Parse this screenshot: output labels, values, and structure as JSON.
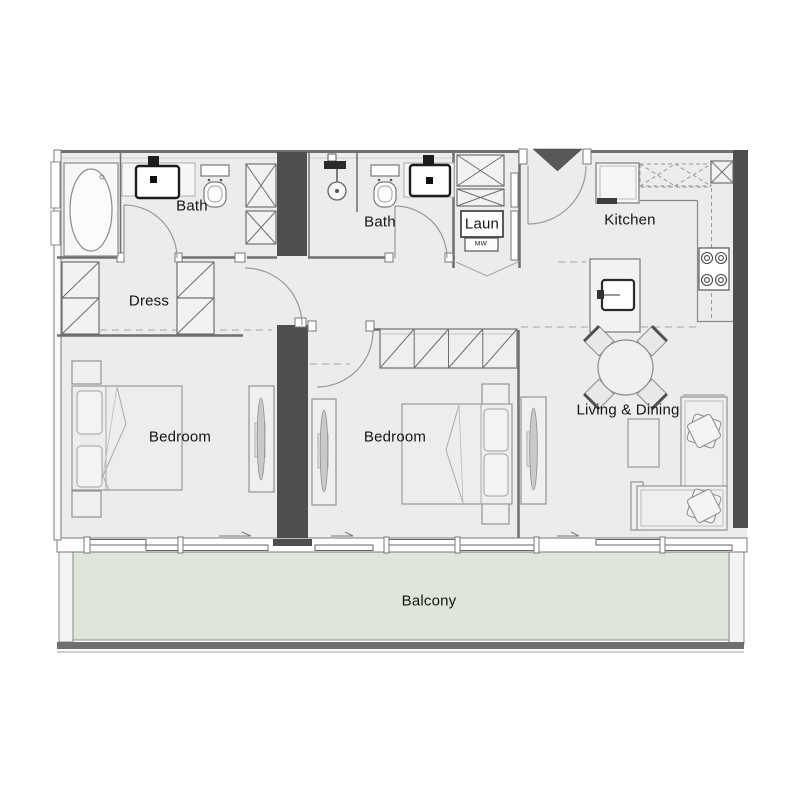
{
  "colors": {
    "background": "#ffffff",
    "floor": "#ececea",
    "balcony_floor": "#dfe5d9",
    "wall_dark": "#4e4e4e",
    "wall_line": "#6f6f6f",
    "furniture_line": "#8a8a8a",
    "fixture_line": "#1c1c1c",
    "text": "#151515"
  },
  "rooms": {
    "bath_main": {
      "label": "Bath"
    },
    "dress": {
      "label": "Dress"
    },
    "bath_second": {
      "label": "Bath"
    },
    "laundry": {
      "label": "Laun",
      "appliance_label": "MW"
    },
    "kitchen": {
      "label": "Kitchen"
    },
    "bedroom_left": {
      "label": "Bedroom"
    },
    "bedroom_middle": {
      "label": "Bedroom"
    },
    "living_dining": {
      "label": "Living & Dining"
    },
    "balcony": {
      "label": "Balcony"
    }
  }
}
